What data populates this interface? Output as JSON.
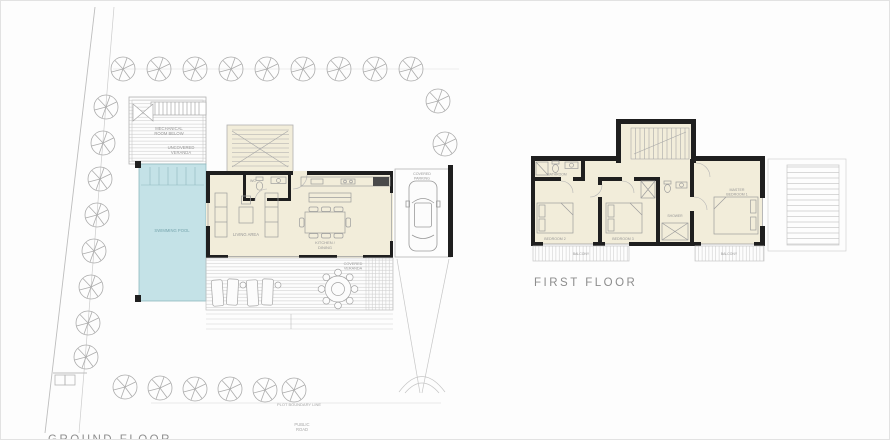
{
  "page": {
    "background": "#fdfdfd"
  },
  "colors": {
    "wall": "#1f1f1f",
    "room_fill": "#f2edda",
    "pool_fill": "#c4e2e7",
    "pool_text": "#76a5ad",
    "line_gray": "#a6a6a6",
    "hatch_gray": "#cccccc",
    "label_gray": "#969696",
    "title_gray": "#8d8d8d"
  },
  "ground_floor": {
    "title": "GROUND FLOOR",
    "labels": {
      "mechanical_room_1": "MECHANICAL",
      "mechanical_room_2": "ROOM BELOW",
      "uncovered_veranda_1": "UNCOVERED",
      "uncovered_veranda_2": "VERANDA",
      "swimming_pool": "SWIMMING POOL",
      "wc": "WC",
      "living_area": "LIVING AREA",
      "kitchen_dining_1": "KITCHEN /",
      "kitchen_dining_2": "DINING",
      "covered_veranda_1": "COVERED",
      "covered_veranda_2": "VERANDA",
      "covered_parking_1": "COVERED",
      "covered_parking_2": "PARKING",
      "plot_boundary_line": "PLOT BOUNDARY LINE",
      "public_road_1": "PUBLIC",
      "public_road_2": "ROAD"
    }
  },
  "first_floor": {
    "title": "FIRST FLOOR",
    "labels": {
      "bathroom": "BATHROOM",
      "bedroom_2": "BEDROOM 2",
      "bedroom_3": "BEDROOM 3",
      "shower": "SHOWER",
      "master_1": "MASTER",
      "master_2": "BEDROOM 1",
      "balcony_left": "BALCONY",
      "balcony_right": "BALCONY"
    }
  }
}
